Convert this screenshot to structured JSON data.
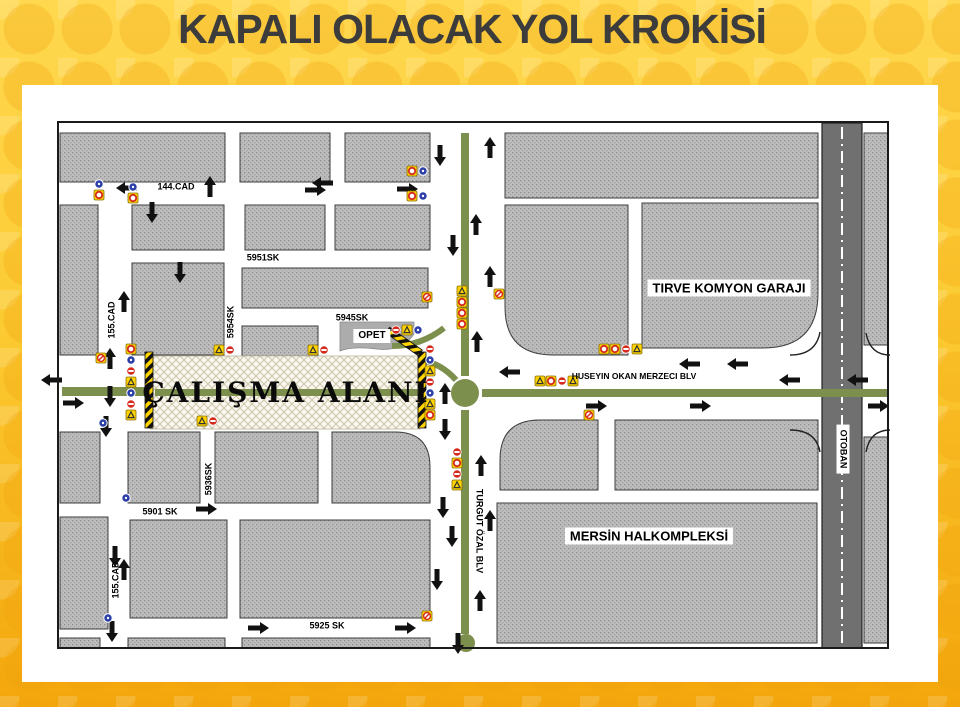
{
  "title": "KAPALI OLACAK YOL KROKİSİ",
  "colors": {
    "page_yellow_top": "#FFD84F",
    "page_orange_bottom": "#F3A60C",
    "title_text": "#3C3C3C",
    "block_gray": "#BDBDBD",
    "road_white": "#FFFFFF",
    "median_green": "#7C8F4D",
    "highway_gray": "#707070",
    "barrier_yellow": "#FFD400",
    "sign_red": "#D42B1E",
    "sign_blue": "#2B3FA8",
    "work_zone_bg": "#FAF7EE"
  },
  "map": {
    "frame": [
      58,
      122,
      830,
      526
    ],
    "work_zone": {
      "label": "ÇALIŞMA ALANI",
      "rect": [
        150,
        356,
        270,
        73
      ],
      "label_pos": [
        286,
        393
      ]
    },
    "street_labels": [
      {
        "text": "144.CAD",
        "x": 176,
        "y": 187,
        "rot": 0,
        "size": 9
      },
      {
        "text": "5951SK",
        "x": 263,
        "y": 258,
        "rot": 0,
        "size": 9
      },
      {
        "text": "5945SK",
        "x": 352,
        "y": 318,
        "rot": 0,
        "size": 9
      },
      {
        "text": "5954SK",
        "x": 231,
        "y": 322,
        "rot": -90,
        "size": 9
      },
      {
        "text": "155.CAD",
        "x": 112,
        "y": 320,
        "rot": -90,
        "size": 9
      },
      {
        "text": "155.CAD",
        "x": 116,
        "y": 580,
        "rot": -90,
        "size": 9
      },
      {
        "text": "5936SK",
        "x": 209,
        "y": 479,
        "rot": -90,
        "size": 9
      },
      {
        "text": "5901 SK",
        "x": 160,
        "y": 512,
        "rot": 0,
        "size": 9
      },
      {
        "text": "5925 SK",
        "x": 327,
        "y": 626,
        "rot": 0,
        "size": 9
      },
      {
        "text": "HUSEYIN OKAN MERZECI BLV",
        "x": 634,
        "y": 376,
        "rot": 0,
        "size": 8.5
      },
      {
        "text": "TURGUT ÖZAL BLV",
        "x": 479,
        "y": 531,
        "rot": 90,
        "size": 9
      }
    ],
    "place_labels": [
      {
        "text": "OPET",
        "x": 372,
        "y": 336,
        "rot": 0,
        "size": 10,
        "boxed": true
      },
      {
        "text": "TIRVE KOMYON GARAJI",
        "x": 729,
        "y": 288,
        "rot": 0,
        "size": 13,
        "boxed": true
      },
      {
        "text": "MERSİN HALKOMPLEKSİ",
        "x": 649,
        "y": 536,
        "rot": 0,
        "size": 13,
        "boxed": true
      },
      {
        "text": "OTOBAN",
        "x": 843,
        "y": 449,
        "rot": 90,
        "size": 9,
        "boxed": true
      }
    ],
    "blocks": [
      [
        60,
        133,
        165,
        49
      ],
      [
        240,
        133,
        90,
        49
      ],
      [
        345,
        133,
        85,
        49
      ],
      [
        60,
        205,
        38,
        150
      ],
      [
        132,
        205,
        92,
        45
      ],
      [
        245,
        205,
        80,
        45
      ],
      [
        335,
        205,
        95,
        45
      ],
      [
        132,
        263,
        92,
        92
      ],
      [
        242,
        268,
        186,
        40
      ],
      [
        242,
        326,
        76,
        30
      ],
      [
        60,
        432,
        40,
        71
      ],
      [
        128,
        432,
        72,
        71
      ],
      [
        215,
        432,
        103,
        71
      ],
      [
        60,
        517,
        48,
        112
      ],
      [
        130,
        520,
        97,
        98
      ],
      [
        240,
        520,
        190,
        98
      ],
      [
        60,
        638,
        40,
        10
      ],
      [
        128,
        638,
        97,
        10
      ],
      [
        242,
        638,
        188,
        10
      ],
      [
        505,
        133,
        313,
        65
      ],
      [
        615,
        420,
        203,
        70
      ],
      [
        497,
        503,
        320,
        140
      ],
      [
        864,
        133,
        24,
        212
      ],
      [
        864,
        437,
        24,
        206
      ]
    ],
    "block_paths": [
      "M505,205 H628 V355 H553 Q505,355 505,307 Z",
      "M642,203 H818 V293 Q818,348 763,348 H642 Z",
      "M500,460 Q500,420 540,420 H598 V490 H500 Z",
      "M332,432 H395 Q430,432 430,467 V503 H332 Z"
    ],
    "opet_block_path": "M340,322 H414 V334 Q402,352 376,349 Q352,346 340,351 Z",
    "highway": {
      "band": [
        822,
        123,
        40,
        525
      ],
      "dash_x": 842,
      "ramps": [
        "M790,355 Q816,355 820,332",
        "M790,430 Q816,430 820,452",
        "M890,355 Q870,355 866,333",
        "M890,430 Q870,430 866,452"
      ]
    },
    "medians": [
      [
        62,
        387,
        92,
        9
      ],
      [
        155,
        389,
        263,
        7
      ],
      [
        482,
        389,
        406,
        8
      ],
      [
        461,
        133,
        8,
        243
      ],
      [
        461,
        410,
        8,
        224
      ]
    ],
    "green_curves": [
      "M392,346 Q421,346 444,328",
      "M420,360 Q441,363 456,380"
    ],
    "roundabout": {
      "cx": 465,
      "cy": 393,
      "r": 14
    },
    "end_circle": {
      "cx": 466,
      "cy": 643,
      "r": 9
    },
    "barriers": [
      {
        "x": 145,
        "y": 352,
        "w": 8,
        "h": 76,
        "rot": 0
      },
      {
        "x": 418,
        "y": 352,
        "w": 8,
        "h": 76,
        "rot": 0
      },
      {
        "x": 384,
        "y": 338,
        "w": 40,
        "h": 7,
        "rot": 35
      }
    ],
    "arrows": [
      [
        137,
        188,
        "left"
      ],
      [
        152,
        202,
        "down"
      ],
      [
        210,
        197,
        "up"
      ],
      [
        305,
        190,
        "right"
      ],
      [
        333,
        183,
        "left"
      ],
      [
        397,
        189,
        "right"
      ],
      [
        440,
        145,
        "down"
      ],
      [
        490,
        158,
        "up"
      ],
      [
        453,
        235,
        "down"
      ],
      [
        476,
        235,
        "up"
      ],
      [
        180,
        262,
        "down"
      ],
      [
        124,
        312,
        "up"
      ],
      [
        62,
        380,
        "left"
      ],
      [
        110,
        369,
        "up"
      ],
      [
        110,
        386,
        "down"
      ],
      [
        63,
        403,
        "right"
      ],
      [
        106,
        416,
        "down"
      ],
      [
        445,
        404,
        "up"
      ],
      [
        445,
        419,
        "down"
      ],
      [
        490,
        287,
        "up"
      ],
      [
        477,
        352,
        "up"
      ],
      [
        452,
        526,
        "down"
      ],
      [
        490,
        531,
        "up"
      ],
      [
        481,
        476,
        "up"
      ],
      [
        443,
        497,
        "down"
      ],
      [
        437,
        569,
        "down"
      ],
      [
        480,
        611,
        "up"
      ],
      [
        458,
        633,
        "down"
      ],
      [
        115,
        546,
        "down"
      ],
      [
        124,
        580,
        "up"
      ],
      [
        196,
        509,
        "right"
      ],
      [
        112,
        621,
        "down"
      ],
      [
        248,
        628,
        "right"
      ],
      [
        395,
        628,
        "right"
      ],
      [
        520,
        372,
        "left"
      ],
      [
        700,
        364,
        "left"
      ],
      [
        748,
        364,
        "left"
      ],
      [
        800,
        380,
        "left"
      ],
      [
        868,
        380,
        "left"
      ],
      [
        586,
        406,
        "right"
      ],
      [
        690,
        406,
        "right"
      ],
      [
        868,
        406,
        "right"
      ]
    ],
    "sign_clusters": [
      {
        "x": 99,
        "y": 184,
        "o": "v",
        "t": [
          "b",
          "ry"
        ]
      },
      {
        "x": 133,
        "y": 187,
        "o": "v",
        "t": [
          "b",
          "ry"
        ]
      },
      {
        "x": 412,
        "y": 171,
        "o": "h",
        "t": [
          "ry",
          "b"
        ]
      },
      {
        "x": 412,
        "y": 196,
        "o": "h",
        "t": [
          "ry",
          "b"
        ]
      },
      {
        "x": 462,
        "y": 291,
        "o": "v",
        "t": [
          "yw",
          "ry",
          "ry",
          "ry"
        ]
      },
      {
        "x": 499,
        "y": 294,
        "o": "v",
        "t": [
          "slash"
        ]
      },
      {
        "x": 427,
        "y": 297,
        "o": "v",
        "t": [
          "slash"
        ]
      },
      {
        "x": 131,
        "y": 349,
        "o": "v",
        "t": [
          "ry",
          "b",
          "ne",
          "yw",
          "b",
          "ne",
          "yw"
        ]
      },
      {
        "x": 430,
        "y": 349,
        "o": "v",
        "t": [
          "ne",
          "b",
          "yw",
          "ne",
          "b",
          "yw",
          "ry"
        ]
      },
      {
        "x": 219,
        "y": 350,
        "o": "h",
        "t": [
          "yw",
          "ne"
        ]
      },
      {
        "x": 313,
        "y": 350,
        "o": "h",
        "t": [
          "yw",
          "ne"
        ]
      },
      {
        "x": 202,
        "y": 421,
        "o": "h",
        "t": [
          "yw",
          "ne"
        ]
      },
      {
        "x": 396,
        "y": 330,
        "o": "h",
        "t": [
          "ne",
          "yw",
          "b"
        ]
      },
      {
        "x": 540,
        "y": 381,
        "o": "h",
        "t": [
          "yw",
          "ry",
          "ne",
          "yw"
        ]
      },
      {
        "x": 604,
        "y": 349,
        "o": "h",
        "t": [
          "ry",
          "ry",
          "ne",
          "yw"
        ]
      },
      {
        "x": 457,
        "y": 452,
        "o": "v",
        "t": [
          "ne",
          "ry",
          "ne",
          "yw"
        ]
      },
      {
        "x": 589,
        "y": 415,
        "o": "v",
        "t": [
          "slash"
        ]
      },
      {
        "x": 427,
        "y": 616,
        "o": "v",
        "t": [
          "slash"
        ]
      },
      {
        "x": 101,
        "y": 358,
        "o": "v",
        "t": [
          "slash"
        ]
      },
      {
        "x": 126,
        "y": 498,
        "o": "v",
        "t": [
          "b"
        ]
      },
      {
        "x": 108,
        "y": 618,
        "o": "v",
        "t": [
          "b"
        ]
      },
      {
        "x": 103,
        "y": 423,
        "o": "v",
        "t": [
          "b"
        ]
      }
    ]
  }
}
